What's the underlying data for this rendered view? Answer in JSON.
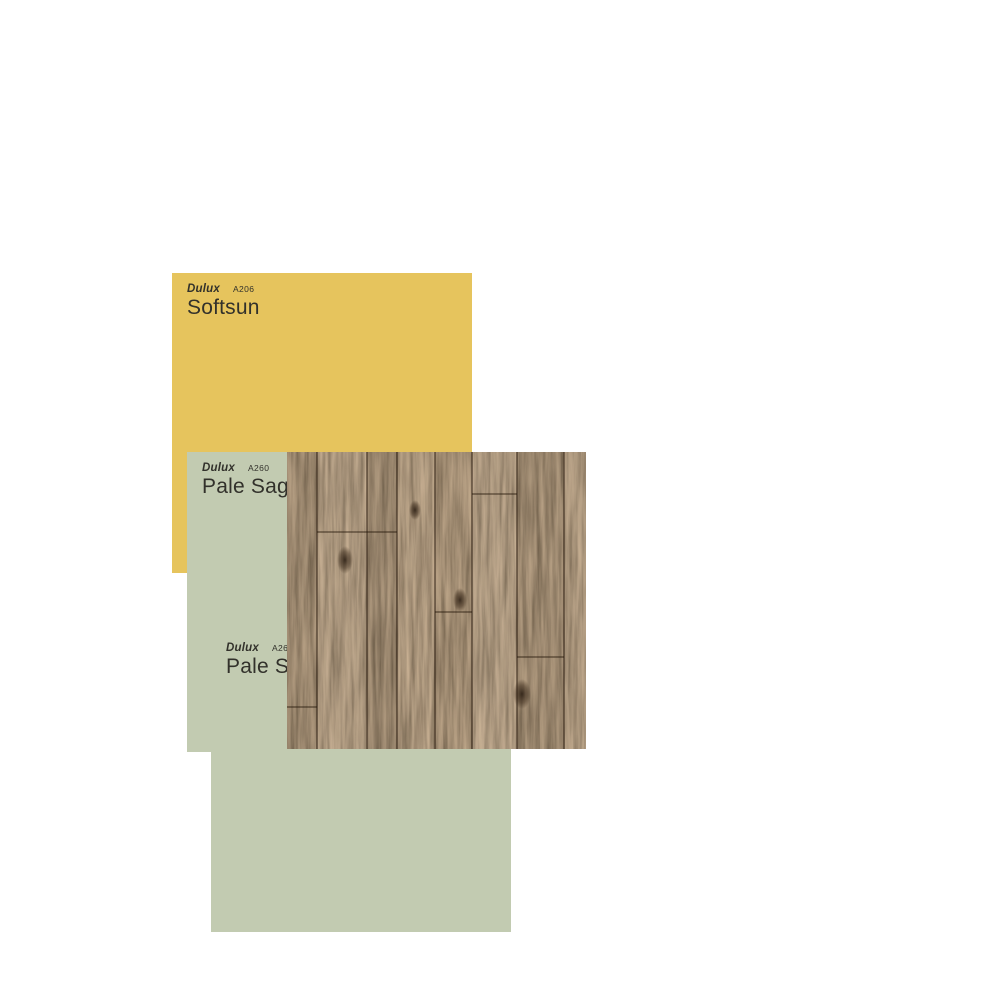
{
  "board": {
    "background": "#ffffff"
  },
  "swatches": [
    {
      "brand": "Dulux",
      "code": "A206",
      "name": "Softsun",
      "color": "#e6c45d",
      "text_color": "#32312b"
    },
    {
      "brand": "Dulux",
      "code": "A260",
      "name": "Pale Sage",
      "color": "#c2cbb1",
      "text_color": "#32312b"
    },
    {
      "brand": "Dulux",
      "code": "A260",
      "name": "Pale Sage",
      "color": "#c2cbb1",
      "text_color": "#32312b"
    }
  ],
  "materials": [
    {
      "name": "dark oak timber flooring",
      "base_color": "#4f3a24",
      "seam_color": "#2a1c10"
    }
  ]
}
